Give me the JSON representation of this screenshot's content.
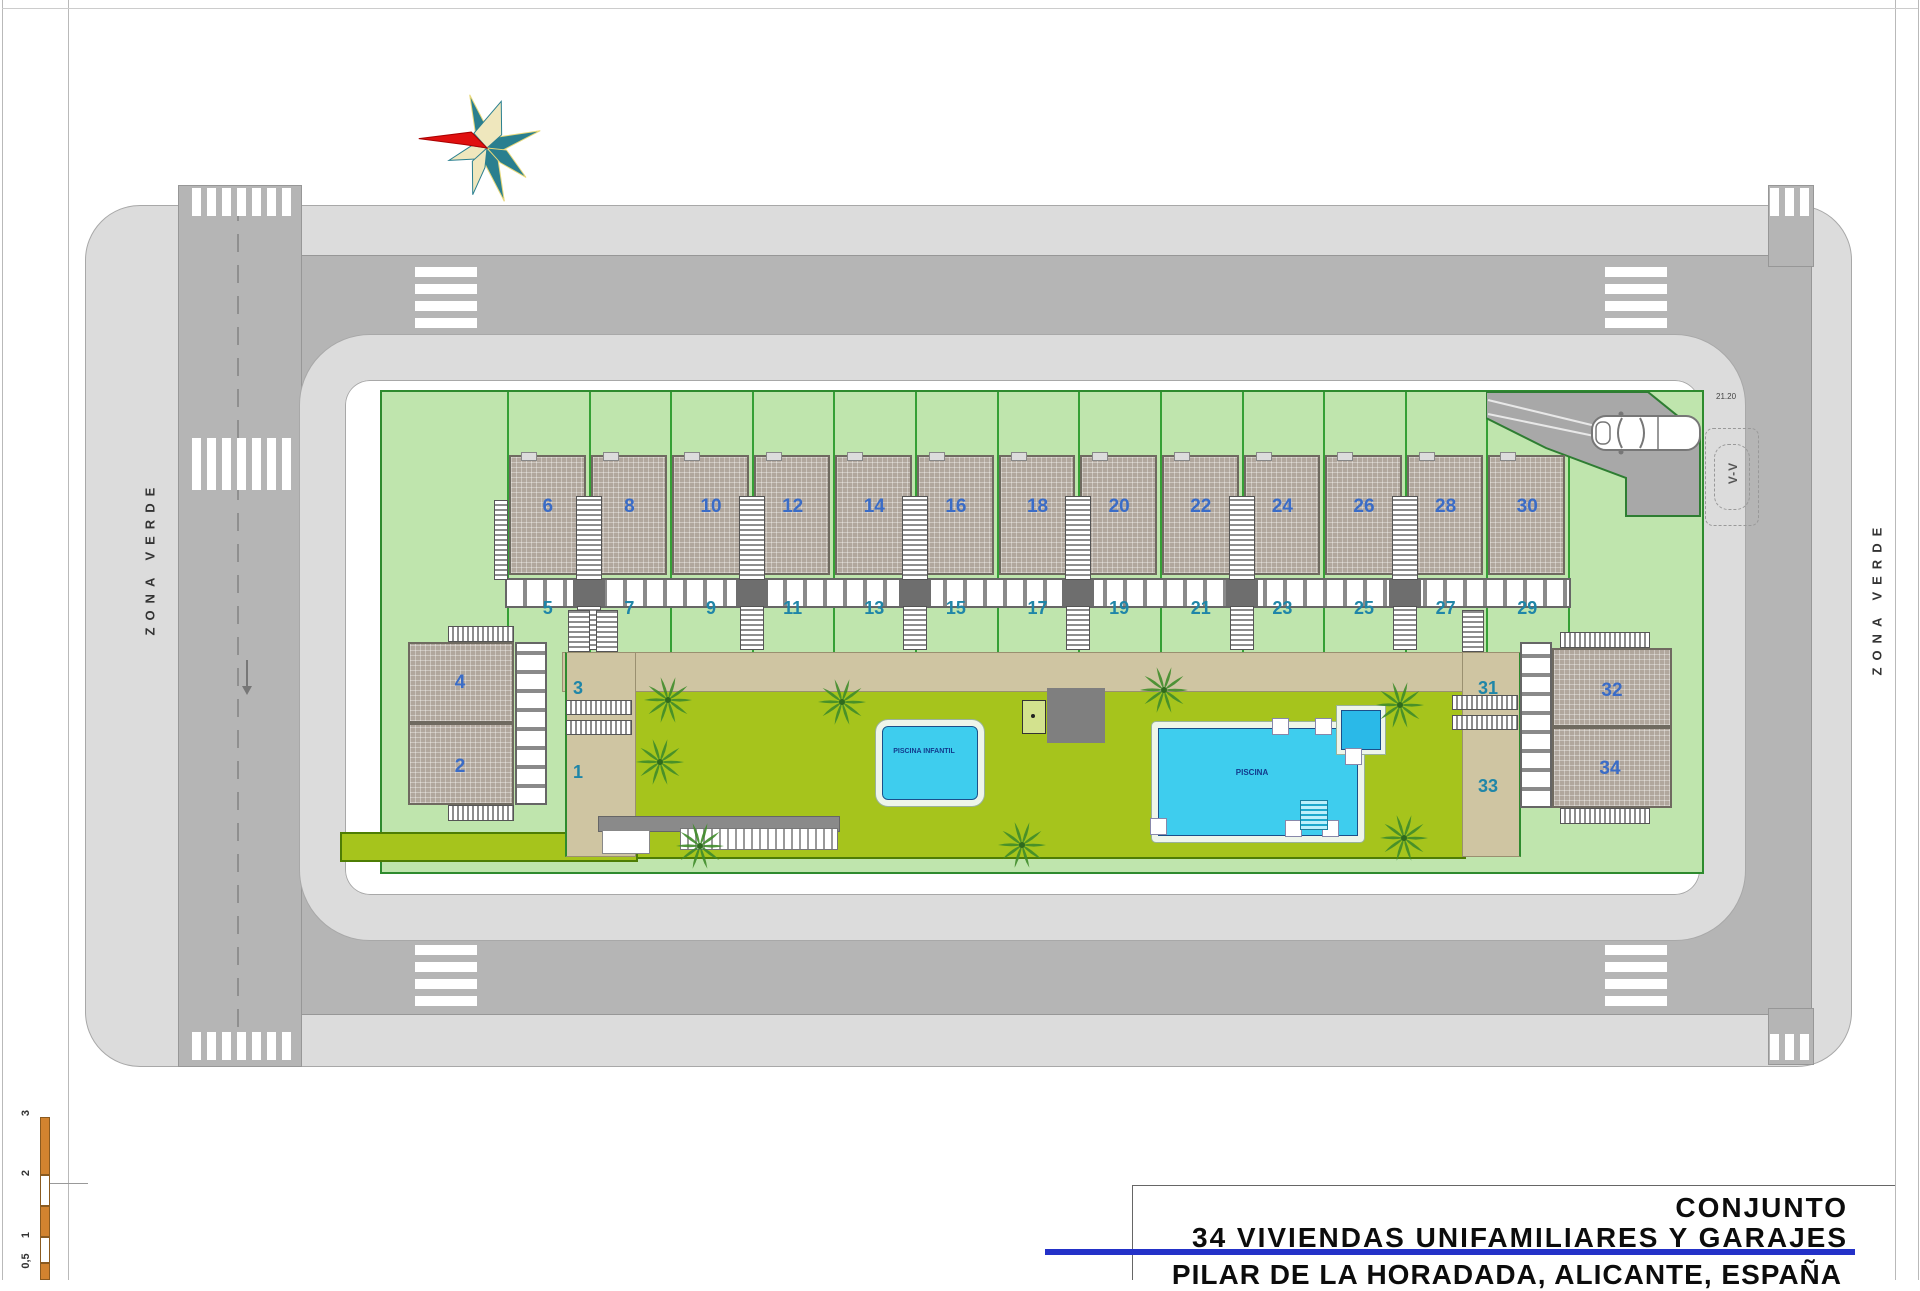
{
  "title_block": {
    "project": "CONJUNTO",
    "subtitle": "34 VIVIENDAS UNIFAMILIARES Y GARAJES",
    "location": "PILAR DE LA HORADADA, ALICANTE, ESPAÑA"
  },
  "annotations": {
    "zona_verde_left": "ZONA VERDE",
    "zona_verde_right": "ZONA VERDE",
    "section_label": "V-V",
    "dimension": "21.20"
  },
  "pools": {
    "kids_label": "PISCINA INFANTIL",
    "main_label": "PISCINA"
  },
  "units": {
    "upper_row": [
      "6",
      "8",
      "10",
      "12",
      "14",
      "16",
      "18",
      "20",
      "22",
      "24",
      "26",
      "28",
      "30"
    ],
    "lower_row": [
      "5",
      "7",
      "9",
      "11",
      "13",
      "15",
      "17",
      "19",
      "21",
      "23",
      "25",
      "27",
      "29"
    ],
    "left_block": {
      "roof_top": "4",
      "roof_bottom": "2",
      "ground_top": "3",
      "ground_bottom": "1"
    },
    "right_block": {
      "roof_top": "32",
      "roof_bottom": "34",
      "ground_top": "31",
      "ground_bottom": "33"
    }
  },
  "scale_bar": {
    "ticks": [
      "3",
      "2",
      "1",
      "0,5"
    ]
  },
  "colors": {
    "accent_blue": "#2331c8",
    "road_gray": "#b5b5b5",
    "sidewalk_gray": "#dcdcdc",
    "plot_green": "#bfe5ad",
    "lawn_green": "#a6c41c",
    "path_tan": "#cfc5a2",
    "pool_cyan": "#3ecdee",
    "roof_gray": "#b1a79d",
    "scale_orange": "#d2832f",
    "number_blue": "#3a6cc7",
    "number_teal": "#1f86a8",
    "boundary_green": "#2e8b2e"
  }
}
